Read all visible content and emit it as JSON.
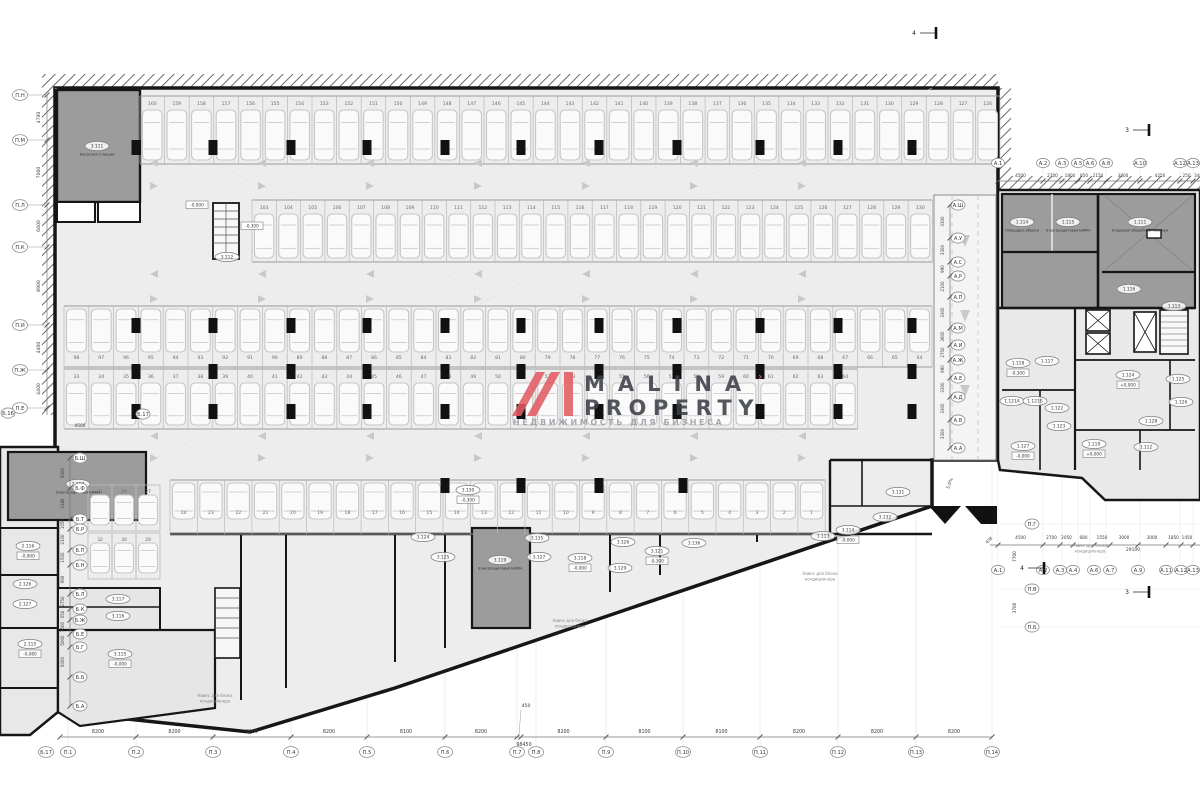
{
  "logo": {
    "word1": "MALINA",
    "word2": "PROPERTY",
    "tagline": "НЕДВИЖИМОСТЬ ДЛЯ БИЗНЕСА",
    "tick": "›",
    "accent": "#e25c63"
  },
  "colors": {
    "wall": "#161616",
    "hall_fill": "#ededed",
    "dark_room": "#9c9c9c",
    "right_fill": "#e9e9e9",
    "stall_line": "#b9b9b9",
    "car_line": "#c6c6c6",
    "grid_line": "#e3e3e3",
    "arrow": "#c9c9c9",
    "axis_text": "#3a3a3a"
  },
  "axes": {
    "bottom": {
      "labels": [
        {
          "t": "Б.17",
          "x": 46
        },
        {
          "t": "П.1",
          "x": 68
        },
        {
          "t": "П.2",
          "x": 136
        },
        {
          "t": "П.3",
          "x": 213
        },
        {
          "t": "П.4",
          "x": 291
        },
        {
          "t": "П.5",
          "x": 367
        },
        {
          "t": "П.6",
          "x": 445
        },
        {
          "t": "П.7",
          "x": 517
        },
        {
          "t": "П.8",
          "x": 536
        },
        {
          "t": "П.9",
          "x": 606
        },
        {
          "t": "П.10",
          "x": 683
        },
        {
          "t": "П.11",
          "x": 760
        },
        {
          "t": "П.12",
          "x": 838
        },
        {
          "t": "П.13",
          "x": 916
        },
        {
          "t": "П.14",
          "x": 992
        }
      ],
      "ticks": [
        60,
        136,
        213,
        291,
        367,
        445,
        517,
        521,
        606,
        683,
        760,
        838,
        916,
        992
      ],
      "dims": [
        "8200",
        "8200",
        "8100",
        "8200",
        "8100",
        "8200",
        "450",
        "8200",
        "8100",
        "8100",
        "8200",
        "8200",
        "8200"
      ],
      "total": "98450",
      "small_dim": "450",
      "y_line": 737,
      "y_label": 752,
      "y_dim": 733
    },
    "left": {
      "labels": [
        {
          "t": "П.Н",
          "y": 95
        },
        {
          "t": "П.М",
          "y": 140
        },
        {
          "t": "П.Л",
          "y": 205
        },
        {
          "t": "П.К",
          "y": 247
        },
        {
          "t": "П.И",
          "y": 325
        },
        {
          "t": "П.Ж",
          "y": 370
        },
        {
          "t": "П.Е",
          "y": 408
        }
      ],
      "dims": [
        "4700",
        "7000",
        "6600",
        "8900",
        "4400",
        "4400"
      ],
      "x_bubble": 20,
      "x_line": 47,
      "x_dim": 40
    },
    "left_extra": [
      {
        "t": "Б.16",
        "x": 8,
        "y": 413
      },
      {
        "t": "Б.17",
        "x": 143,
        "y": 414
      }
    ],
    "left_extra_dim": {
      "t": "4500",
      "x": 80,
      "y": 427
    },
    "a_top": {
      "labels": [
        {
          "t": "А.1",
          "x": 998
        },
        {
          "t": "А.2",
          "x": 1043
        },
        {
          "t": "А.3",
          "x": 1062
        },
        {
          "t": "А.5",
          "x": 1078
        },
        {
          "t": "А.6",
          "x": 1090
        },
        {
          "t": "А.8",
          "x": 1106
        },
        {
          "t": "А.10",
          "x": 1140
        },
        {
          "t": "А.12",
          "x": 1180
        },
        {
          "t": "А.13",
          "x": 1193
        }
      ],
      "dims": [
        "4500",
        "2700",
        "1800",
        "850",
        "2150",
        "3800",
        "4250",
        "250"
      ],
      "tail_dim": "348",
      "y_label": 163,
      "y_dim": 177,
      "y_line": 181
    },
    "a_bottom": {
      "labels": [
        {
          "t": "А.1",
          "x": 998
        },
        {
          "t": "А.2",
          "x": 1043
        },
        {
          "t": "А.3",
          "x": 1060
        },
        {
          "t": "А.4",
          "x": 1073
        },
        {
          "t": "А.6",
          "x": 1094
        },
        {
          "t": "А.7",
          "x": 1110
        },
        {
          "t": "А.9",
          "x": 1138
        },
        {
          "t": "А.11",
          "x": 1166
        },
        {
          "t": "А.12",
          "x": 1181
        },
        {
          "t": "А.13",
          "x": 1193
        }
      ],
      "dims": [
        "4500",
        "2700",
        "2050",
        "680",
        "1550",
        "3000",
        "3000",
        "1850",
        "1450"
      ],
      "lead_dim": "658",
      "total": "29100",
      "y_label": 570,
      "y_dim": 539,
      "y_line": 545
    },
    "a_right_vert": {
      "labels": [
        {
          "t": "А.Ш",
          "y": 205
        },
        {
          "t": "А.У",
          "y": 238
        },
        {
          "t": "А.С",
          "y": 262
        },
        {
          "t": "А.Р",
          "y": 276
        },
        {
          "t": "А.П",
          "y": 297
        },
        {
          "t": "А.М",
          "y": 328
        },
        {
          "t": "А.И",
          "y": 345
        },
        {
          "t": "А.Ж",
          "y": 360
        },
        {
          "t": "А.Е",
          "y": 378
        },
        {
          "t": "А.Д",
          "y": 397
        },
        {
          "t": "А.В",
          "y": 420
        },
        {
          "t": "А.А",
          "y": 448
        }
      ],
      "dims": [
        "3300",
        "3300",
        "990",
        "2100",
        "3300",
        "3600",
        "2750",
        "990",
        "3300",
        "3300",
        "3300"
      ],
      "x_bubble": 958,
      "x_dim": 944,
      "x_line": 950
    },
    "b_left_vert": {
      "labels": [
        {
          "t": "Б.Ш",
          "y": 458
        },
        {
          "t": "Б.Ф",
          "y": 488
        },
        {
          "t": "Б.Т",
          "y": 519
        },
        {
          "t": "Б.Р",
          "y": 529
        },
        {
          "t": "Б.П",
          "y": 550
        },
        {
          "t": "Б.Н",
          "y": 565
        },
        {
          "t": "Б.Л",
          "y": 594
        },
        {
          "t": "Б.К",
          "y": 609
        },
        {
          "t": "Б.Ж",
          "y": 620
        },
        {
          "t": "Б.Е",
          "y": 634
        },
        {
          "t": "Б.Г",
          "y": 647
        },
        {
          "t": "Б.Б",
          "y": 677
        },
        {
          "t": "Б.А",
          "y": 706
        }
      ],
      "dims": [
        "5000",
        "3180",
        "1050",
        "2100",
        "1500",
        "990",
        "2750",
        "550",
        "1500",
        "5000",
        "5000"
      ],
      "x_bubble": 80,
      "x_dim": 64,
      "x_line": 70
    },
    "p_right_vert": {
      "labels": [
        {
          "t": "П.Г",
          "y": 524
        },
        {
          "t": "П.В",
          "y": 589
        },
        {
          "t": "П.Б",
          "y": 627
        }
      ],
      "dims": [
        "7700",
        "3700"
      ],
      "x_bubble": 1032,
      "x_dim": 1016
    }
  },
  "parking_rows": [
    {
      "y": 96,
      "h": 68,
      "x0": 140,
      "pitch": 24.57,
      "count": 35,
      "start": 160,
      "step": -1,
      "num_off": 9,
      "car_off": 14
    },
    {
      "y": 200,
      "h": 62,
      "x0": 252,
      "pitch": 24.3,
      "count": 28,
      "start": 103,
      "step": 1,
      "num_off": 9,
      "car_off": 14
    },
    {
      "y": 306,
      "h": 61,
      "x0": 64,
      "pitch": 24.8,
      "count": 35,
      "start": 98,
      "step": -1,
      "num_off": 53,
      "car_off": 3
    },
    {
      "y": 369,
      "h": 60,
      "x0": 64,
      "pitch": 24.8,
      "count": 32,
      "start": 33,
      "step": 1,
      "num_off": 9,
      "car_off": 14
    },
    {
      "y": 480,
      "h": 54,
      "x0": 170,
      "pitch": 27.3,
      "count": 24,
      "start": 24,
      "step": -1,
      "num_off": 34,
      "car_off": 3
    }
  ],
  "stall_pair_block": {
    "x": 88,
    "y": 485,
    "stall_w": 24,
    "stall_h": 46,
    "rows": [
      [
        "31",
        "29",
        "27"
      ],
      [
        "32",
        "30",
        "28"
      ]
    ]
  },
  "rooms": [
    {
      "id": "3.111",
      "sub": "Насосная станция",
      "x": 97,
      "y": 146
    },
    {
      "id": "3.112",
      "x": 227,
      "y": 257
    },
    {
      "id": "2.120",
      "sub": "Электрощитовая БКФН",
      "x": 78,
      "y": 484
    },
    {
      "id": "2.116",
      "lvl": "-0,900",
      "x": 28,
      "y": 546
    },
    {
      "id": "2.126",
      "x": 25,
      "y": 584
    },
    {
      "id": "2.127",
      "x": 25,
      "y": 604
    },
    {
      "id": "2.115",
      "lvl": "-0,080",
      "x": 30,
      "y": 644
    },
    {
      "id": "3.117",
      "x": 118,
      "y": 599
    },
    {
      "id": "3.116",
      "x": 118,
      "y": 616
    },
    {
      "id": "3.115",
      "lvl": "-0,000",
      "x": 120,
      "y": 654
    },
    {
      "id": "3.130",
      "lvl": "-0,300",
      "x": 468,
      "y": 490
    },
    {
      "id": "3.124",
      "x": 423,
      "y": 537
    },
    {
      "id": "3.125",
      "x": 443,
      "y": 557
    },
    {
      "id": "3.135",
      "x": 537,
      "y": 538
    },
    {
      "id": "3.127",
      "x": 539,
      "y": 557
    },
    {
      "id": "3.119",
      "sub": "Электрощитовая БКФН",
      "x": 500,
      "y": 560
    },
    {
      "id": "3.118",
      "lvl": "-0,000",
      "x": 580,
      "y": 558
    },
    {
      "id": "3.126",
      "x": 623,
      "y": 542
    },
    {
      "id": "3.129",
      "x": 620,
      "y": 568
    },
    {
      "id": "3.121",
      "lvl": "-0,300",
      "x": 657,
      "y": 551
    },
    {
      "id": "3.136",
      "x": 694,
      "y": 543
    },
    {
      "id": "3.131",
      "x": 898,
      "y": 492
    },
    {
      "id": "3.132",
      "x": 885,
      "y": 517
    },
    {
      "id": "3.114",
      "lvl": "-0,000",
      "x": 848,
      "y": 530
    },
    {
      "id": "3.113",
      "x": 823,
      "y": 536
    },
    {
      "id": "1.114",
      "sub": "Площадка уборки",
      "x": 1022,
      "y": 222
    },
    {
      "id": "1.115",
      "sub": "Электрощитовая БКФН",
      "x": 1068,
      "y": 222
    },
    {
      "id": "1.111",
      "sub": "Кладовая уборочной техники",
      "x": 1140,
      "y": 222
    },
    {
      "id": "1.116",
      "x": 1129,
      "y": 289
    },
    {
      "id": "1.113",
      "x": 1174,
      "y": 306
    },
    {
      "id": "1.118",
      "lvl": "-0,300",
      "x": 1018,
      "y": 363
    },
    {
      "id": "1.117",
      "x": 1047,
      "y": 361
    },
    {
      "id": "1.121А",
      "x": 1012,
      "y": 401
    },
    {
      "id": "1.121Б",
      "x": 1035,
      "y": 401
    },
    {
      "id": "1.122",
      "x": 1057,
      "y": 408
    },
    {
      "id": "1.123",
      "x": 1059,
      "y": 426
    },
    {
      "id": "1.127",
      "lvl": "-0,000",
      "x": 1023,
      "y": 446
    },
    {
      "id": "1.124",
      "lvl": "+0,000",
      "x": 1128,
      "y": 375
    },
    {
      "id": "1.125",
      "x": 1178,
      "y": 379
    },
    {
      "id": "1.126",
      "x": 1181,
      "y": 402
    },
    {
      "id": "1.128",
      "x": 1151,
      "y": 421
    },
    {
      "id": "1.119",
      "lvl": "+0,000",
      "x": 1094,
      "y": 444
    },
    {
      "id": "1.112",
      "x": 1146,
      "y": 447
    }
  ],
  "elevations": [
    {
      "t": "-0,000",
      "x": 197,
      "y": 206
    },
    {
      "t": "-0,300",
      "x": 252,
      "y": 227
    }
  ],
  "notes": [
    {
      "lines": [
        "Навес для блока",
        "кондиционера"
      ],
      "x": 215,
      "y": 697
    },
    {
      "lines": [
        "Навес для блока",
        "кондиционера"
      ],
      "x": 570,
      "y": 622
    },
    {
      "lines": [
        "Навес для блока",
        "кондиционера"
      ],
      "x": 820,
      "y": 575
    },
    {
      "lines": [
        "Навес для блока",
        "кондиционера"
      ],
      "x": 1090,
      "y": 547
    }
  ],
  "lane_arrows": [
    {
      "y": 163,
      "dir": "l"
    },
    {
      "y": 186,
      "dir": "r"
    },
    {
      "y": 274,
      "dir": "l"
    },
    {
      "y": 299,
      "dir": "r"
    },
    {
      "y": 436,
      "dir": "l"
    },
    {
      "y": 458,
      "dir": "r"
    }
  ],
  "columns": {
    "xs": [
      136,
      213,
      291,
      367,
      445,
      521,
      599,
      677,
      760,
      838,
      912
    ],
    "ys": [
      140,
      318,
      364,
      404
    ],
    "extra_row": {
      "y": 478,
      "xs": [
        445,
        521,
        599,
        683
      ]
    }
  },
  "section_markers": [
    {
      "n": "4",
      "x": 920,
      "y": 33
    },
    {
      "n": "4",
      "x": 1028,
      "y": 568
    },
    {
      "n": "3",
      "x": 1133,
      "y": 130
    },
    {
      "n": "3",
      "x": 1133,
      "y": 592
    }
  ],
  "ramp": {
    "slope": "5,0%",
    "x": 951,
    "y": 484
  }
}
